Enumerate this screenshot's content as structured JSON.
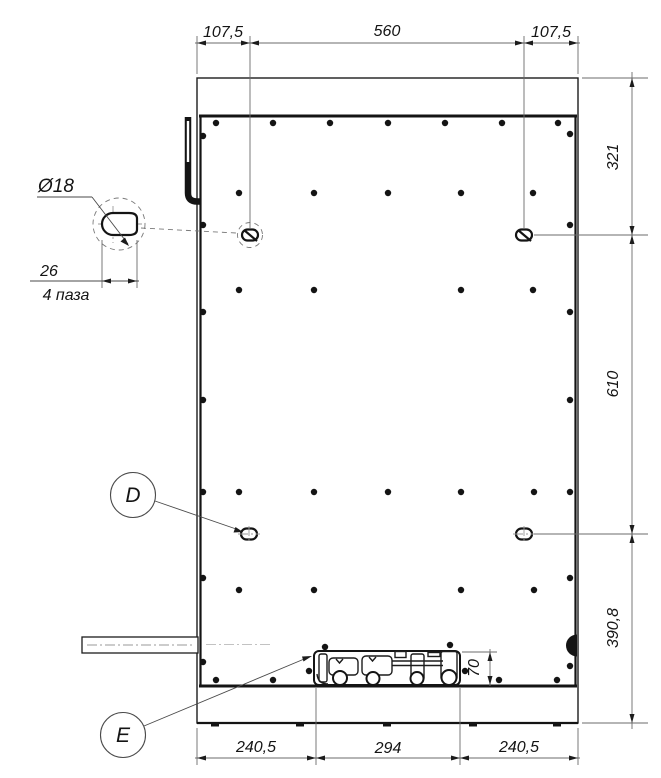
{
  "dimensions": {
    "top": {
      "left": "107,5",
      "middle": "560",
      "right": "107,5"
    },
    "right_side": {
      "upper": "321",
      "middle": "610",
      "lower": "390,8"
    },
    "bottom": {
      "left": "240,5",
      "middle": "294",
      "right": "240,5"
    },
    "assembly_height": "70"
  },
  "detail_callout": {
    "diameter": "Ø18",
    "slot_length": "26",
    "slot_note": "4 паза"
  },
  "view_labels": {
    "d": "D",
    "e": "E"
  },
  "colors": {
    "background": "#ffffff",
    "main_line": "#1c1c1c",
    "thin_line": "#6b6b6b",
    "centerline": "#9a9a9a"
  },
  "geometry": {
    "hole_radius": 3.2,
    "holes": [
      [
        216,
        123
      ],
      [
        273,
        123
      ],
      [
        330,
        123
      ],
      [
        388,
        123
      ],
      [
        445,
        123
      ],
      [
        502,
        123
      ],
      [
        558,
        123
      ],
      [
        239,
        193
      ],
      [
        314,
        193
      ],
      [
        388,
        193
      ],
      [
        461,
        193
      ],
      [
        533,
        193
      ],
      [
        239,
        290
      ],
      [
        314,
        290
      ],
      [
        461,
        290
      ],
      [
        533,
        290
      ],
      [
        239,
        492
      ],
      [
        314,
        492
      ],
      [
        388,
        492
      ],
      [
        461,
        492
      ],
      [
        534,
        492
      ],
      [
        239,
        590
      ],
      [
        314,
        590
      ],
      [
        461,
        590
      ],
      [
        534,
        590
      ],
      [
        216,
        680
      ],
      [
        273,
        680
      ],
      [
        499,
        680
      ],
      [
        557,
        680
      ],
      [
        203,
        136
      ],
      [
        203,
        225
      ],
      [
        203,
        312
      ],
      [
        203,
        400
      ],
      [
        203,
        492
      ],
      [
        203,
        578
      ],
      [
        203,
        662
      ],
      [
        570,
        134
      ],
      [
        570,
        225
      ],
      [
        570,
        312
      ],
      [
        570,
        400
      ],
      [
        570,
        492
      ],
      [
        570,
        578
      ],
      [
        570,
        666
      ],
      [
        325,
        647
      ],
      [
        450,
        645
      ],
      [
        309,
        671
      ],
      [
        465,
        671
      ]
    ]
  }
}
